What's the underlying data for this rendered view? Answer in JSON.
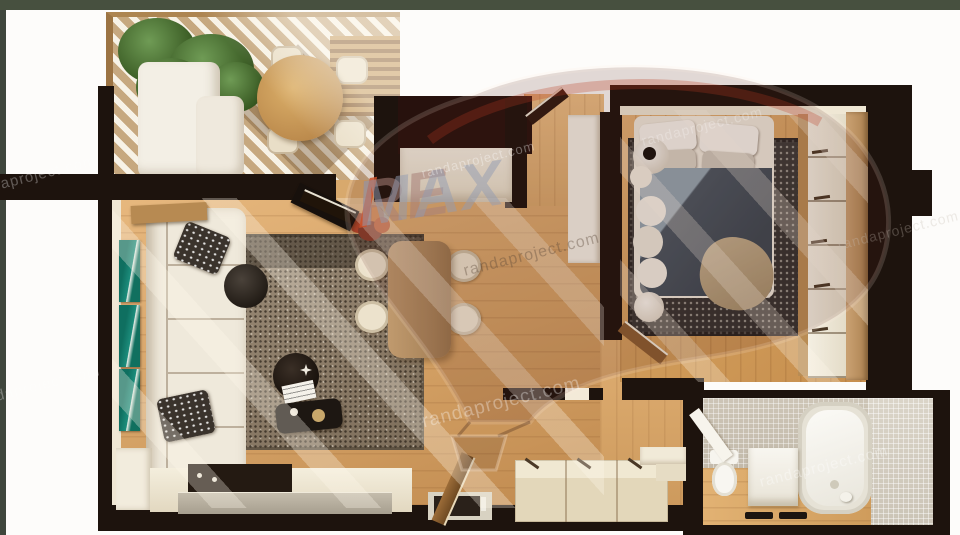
{
  "meta": {
    "type": "3d-floor-plan-top-view-render",
    "width_px": 960,
    "height_px": 535
  },
  "watermark": {
    "brand_re": "RE",
    "brand_slash": "/",
    "brand_max": "MAX",
    "site": "randaproject.com",
    "brand_red": "#cd5028",
    "brand_blue": "#9aa2b8"
  },
  "palette": {
    "walls": "#1d130d",
    "floor_wood": "#d3a064",
    "bedroom_floor": "#cf9a58",
    "outside": "#fdfcfa",
    "frame_strip": "#47503f",
    "sofa_cream": "#efe9db",
    "rug_living": "#8a7a66",
    "rug_bedroom": "#3b3a38",
    "duvet_slate": "#3d4852",
    "teal_art": "#0f6f60",
    "mosaic_tile": "#cdc5b6",
    "terrace_stripe_tan": "#c6a87f"
  },
  "rooms": [
    {
      "name": "terrace",
      "features": [
        "round-dining-table",
        "four-chairs",
        "corner-sofa",
        "green-plant",
        "slatted-bench",
        "striped-deck"
      ]
    },
    {
      "name": "living-room",
      "features": [
        "l-shaped-cream-sofa",
        "two-dark-pillows",
        "textured-rug",
        "round-coffee-table",
        "tray-table",
        "book",
        "teal-wall-art-x3",
        "paper-floor-lamp",
        "autumn-plant",
        "tv"
      ]
    },
    {
      "name": "kitchen",
      "features": [
        "counter",
        "dark-cooktop",
        "steel-front",
        "sink",
        "open-wood-door"
      ]
    },
    {
      "name": "dining-area",
      "features": [
        "wood-table",
        "four-cream-chairs"
      ]
    },
    {
      "name": "entry-hall",
      "features": [
        "white-console",
        "open-entry-door",
        "white-closet"
      ]
    },
    {
      "name": "bedroom",
      "features": [
        "double-bed",
        "slate-duvet",
        "beige-throw",
        "white-pillows",
        "dark-dotted-rug",
        "round-nightstands",
        "wardrobe-with-drawers",
        "wood-wardrobe-panel",
        "open-door"
      ]
    },
    {
      "name": "hallway",
      "features": [
        "cream-sideboard-3-doors",
        "two-steps",
        "open-wood-door"
      ]
    },
    {
      "name": "bathroom",
      "features": [
        "bathtub",
        "toilet",
        "washing-machine",
        "mosaic-walls",
        "wood-floor",
        "two-dark-mats",
        "open-white-door"
      ]
    }
  ]
}
